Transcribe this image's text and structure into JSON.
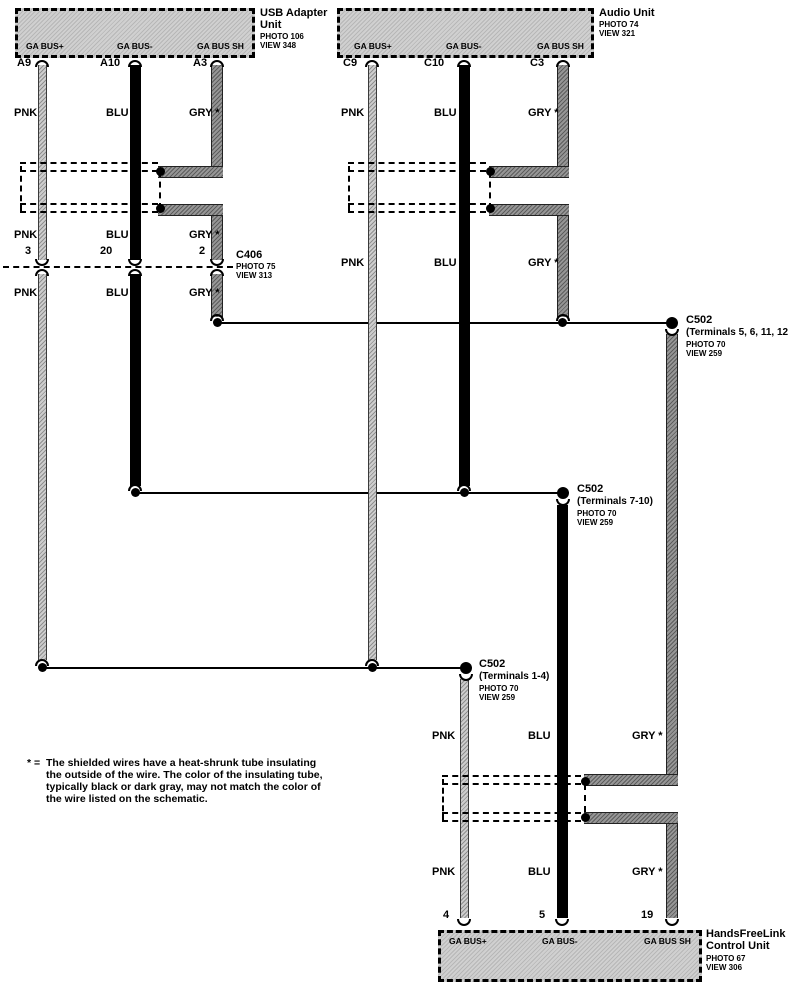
{
  "units": {
    "usb": {
      "title_line1": "USB Adapter",
      "title_line2": "Unit",
      "photo": "PHOTO 106",
      "view": "VIEW 348",
      "terminals": [
        "GA BUS+",
        "GA BUS-",
        "GA BUS SH"
      ],
      "pins": [
        "A9",
        "A10",
        "A3"
      ]
    },
    "audio": {
      "title_line1": "Audio Unit",
      "photo": "PHOTO 74",
      "view": "VIEW 321",
      "terminals": [
        "GA BUS+",
        "GA BUS-",
        "GA BUS SH"
      ],
      "pins": [
        "C9",
        "C10",
        "C3"
      ]
    },
    "hfl": {
      "title_line1": "HandsFreeLink",
      "title_line2": "Control Unit",
      "photo": "PHOTO 67",
      "view": "VIEW 306",
      "terminals": [
        "GA BUS+",
        "GA BUS-",
        "GA BUS SH"
      ],
      "pins": [
        "4",
        "5",
        "19"
      ]
    }
  },
  "connectors": {
    "c406": {
      "name": "C406",
      "photo": "PHOTO 75",
      "view": "VIEW 313",
      "pins": [
        "3",
        "20",
        "2"
      ]
    },
    "c502_shield": {
      "name": "C502",
      "terminals": "(Terminals 5, 6, 11, 12)",
      "photo": "PHOTO 70",
      "view": "VIEW 259"
    },
    "c502_bus_minus": {
      "name": "C502",
      "terminals": "(Terminals 7-10)",
      "photo": "PHOTO 70",
      "view": "VIEW 259"
    },
    "c502_bus_plus": {
      "name": "C502",
      "terminals": "(Terminals 1-4)",
      "photo": "PHOTO 70",
      "view": "VIEW 259"
    }
  },
  "wire_labels": {
    "pnk": "PNK",
    "blu": "BLU",
    "gry": "GRY *"
  },
  "note": {
    "prefix": "* =",
    "line1": "The shielded wires have a heat-shrunk tube insulating",
    "line2": "the outside of the wire. The color of the insulating tube,",
    "line3": "typically black or dark gray, may not match the color of",
    "line4": "the wire listed on the schematic."
  },
  "colors": {
    "pnk_wire": "#cdcdcd",
    "blu_wire": "#000000",
    "gry_wire": "#969696",
    "box_fill": "#d0d0d0",
    "line": "#000000"
  }
}
